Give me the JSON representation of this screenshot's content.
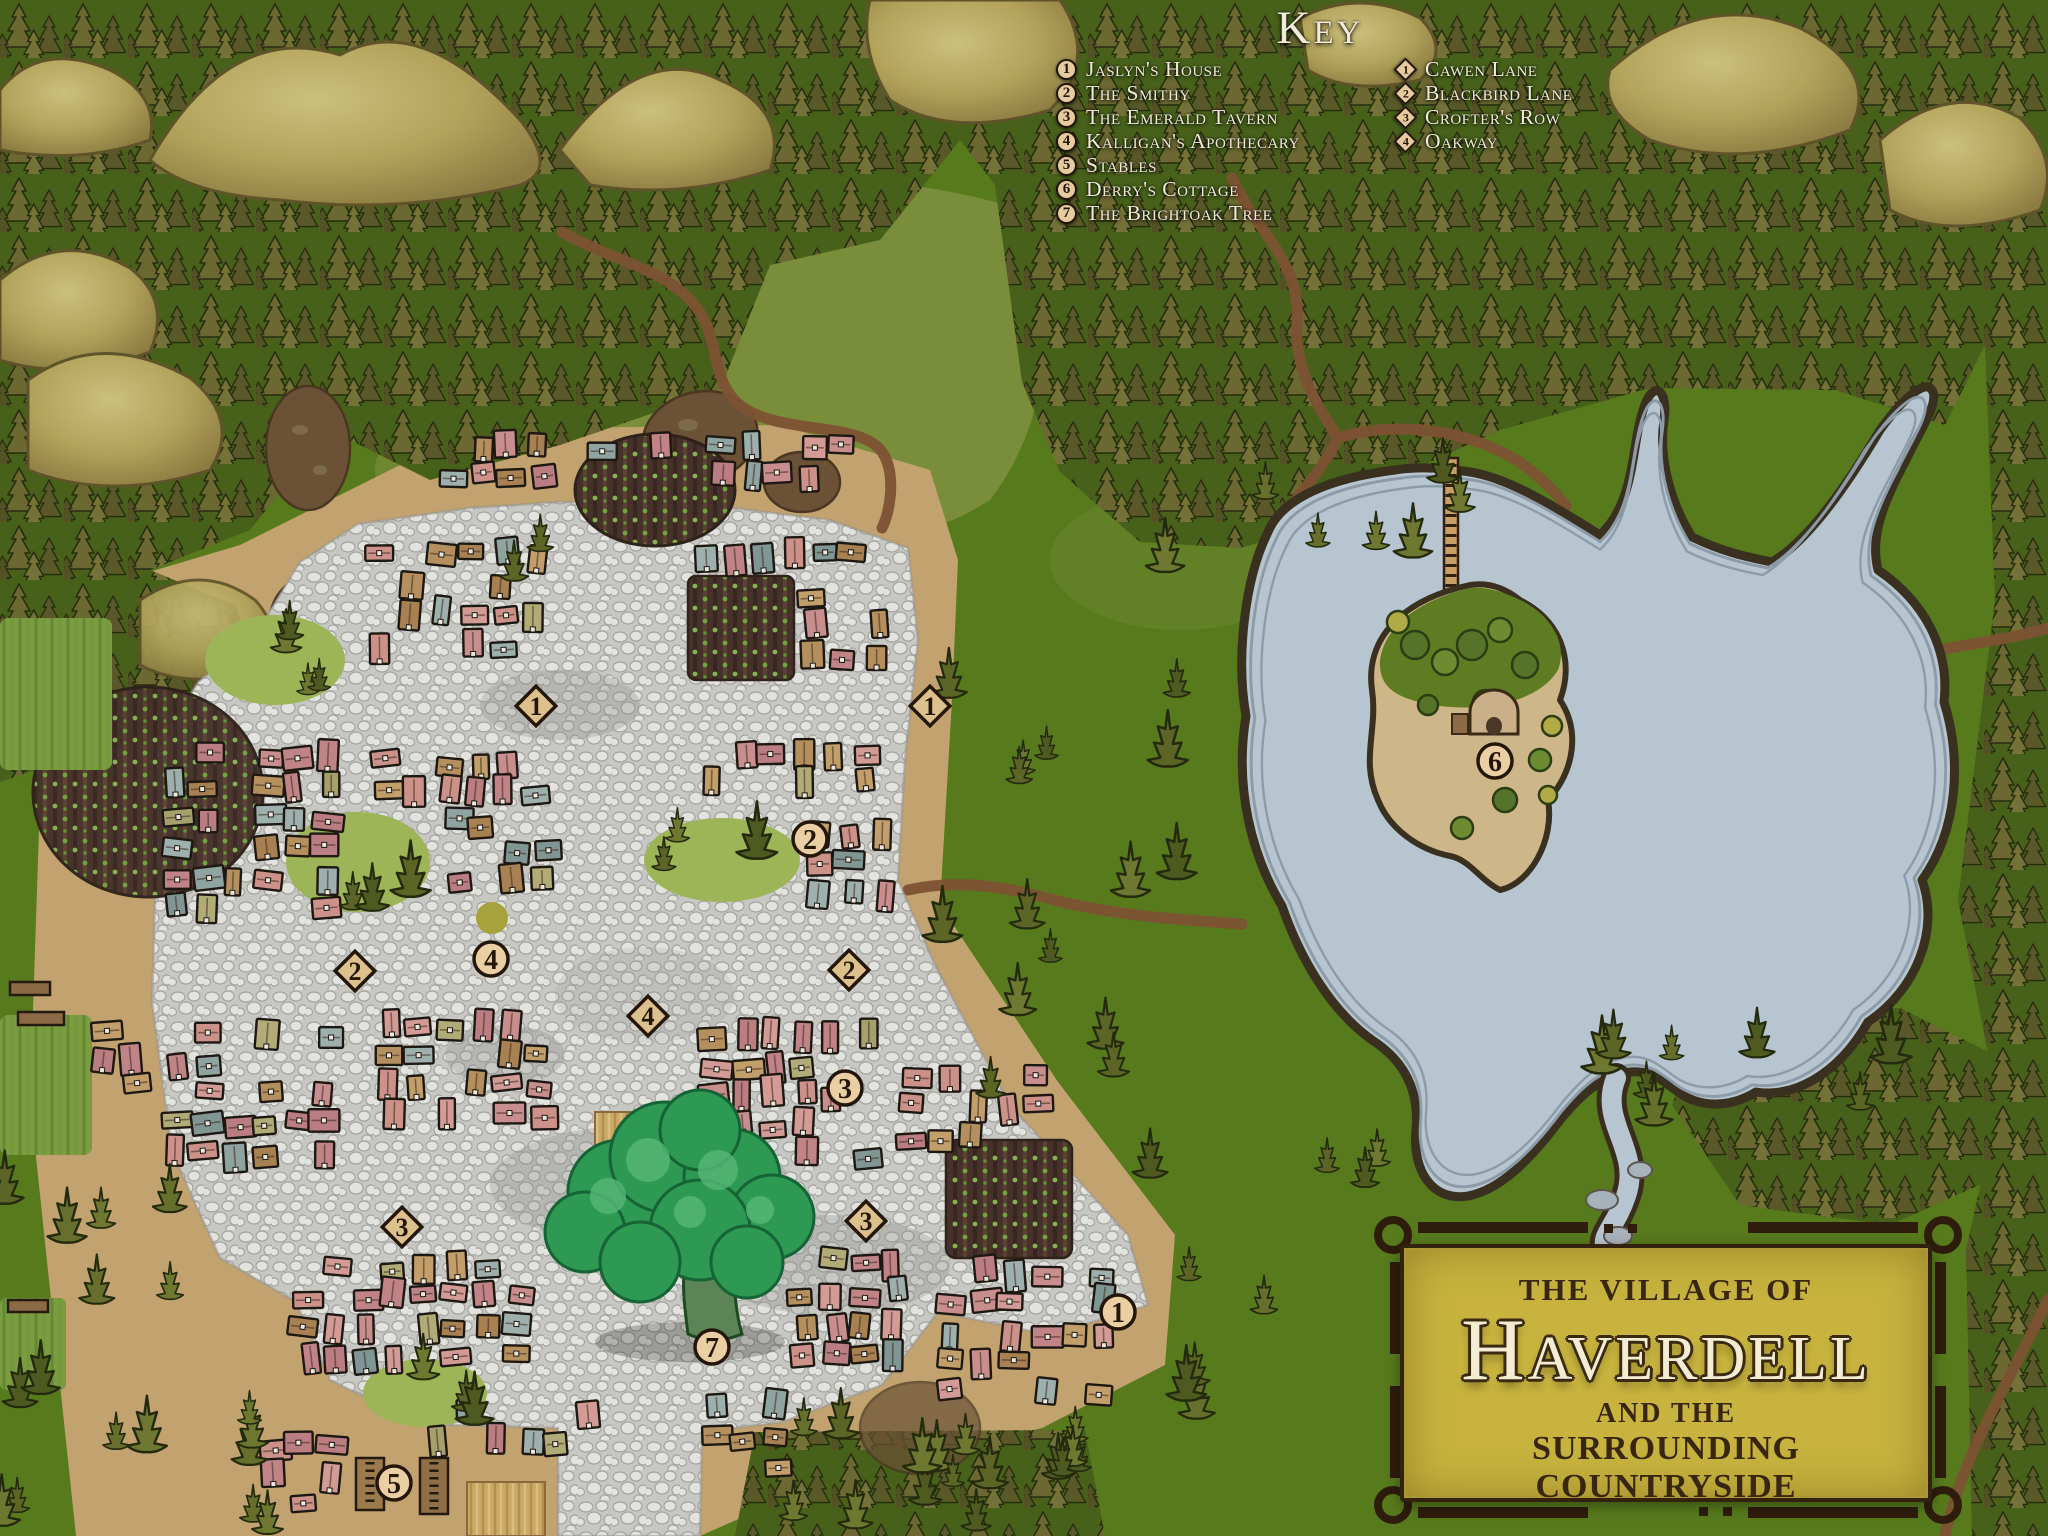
{
  "map": {
    "key": {
      "title": "Key",
      "locations": [
        {
          "num": "1",
          "label": "Jaslyn's House"
        },
        {
          "num": "2",
          "label": "The Smithy"
        },
        {
          "num": "3",
          "label": "The Emerald Tavern"
        },
        {
          "num": "4",
          "label": "Kalligan's Apothecary"
        },
        {
          "num": "5",
          "label": "Stables"
        },
        {
          "num": "6",
          "label": "Derry's Cottage"
        },
        {
          "num": "7",
          "label": "The Brightoak Tree"
        }
      ],
      "roads": [
        {
          "num": "1",
          "label": "Cawen Lane"
        },
        {
          "num": "2",
          "label": "Blackbird Lane"
        },
        {
          "num": "3",
          "label": "Crofter's Row"
        },
        {
          "num": "4",
          "label": "Oakway"
        }
      ]
    },
    "cartouche": {
      "line1": "THE VILLAGE OF",
      "name": "Haverdell",
      "line2": "AND THE",
      "line3": "SURROUNDING COUNTRYSIDE"
    },
    "markers": {
      "circles": [
        {
          "n": "1",
          "x": 1118,
          "y": 1312
        },
        {
          "n": "2",
          "x": 810,
          "y": 839
        },
        {
          "n": "3",
          "x": 845,
          "y": 1088
        },
        {
          "n": "4",
          "x": 491,
          "y": 959
        },
        {
          "n": "5",
          "x": 394,
          "y": 1483
        },
        {
          "n": "6",
          "x": 1495,
          "y": 761
        },
        {
          "n": "7",
          "x": 712,
          "y": 1347
        }
      ],
      "diamonds": [
        {
          "n": "1",
          "x": 536,
          "y": 706
        },
        {
          "n": "1",
          "x": 930,
          "y": 706
        },
        {
          "n": "2",
          "x": 355,
          "y": 971
        },
        {
          "n": "2",
          "x": 849,
          "y": 970
        },
        {
          "n": "3",
          "x": 402,
          "y": 1227
        },
        {
          "n": "3",
          "x": 866,
          "y": 1221
        },
        {
          "n": "4",
          "x": 648,
          "y": 1016
        }
      ]
    },
    "colors": {
      "grass": "#577a1d",
      "forest": "#47611a",
      "water": "#b7c5d0",
      "cobblestone": "#cbcbc7",
      "dirt": "#c2a370",
      "road": "#7d5233",
      "marker_fill": "#e9cfa3",
      "marker_stroke": "#241709",
      "cartouche_bg": "#c7b33e",
      "cartouche_text": "#382610",
      "key_text": "#f1ebd8"
    }
  }
}
